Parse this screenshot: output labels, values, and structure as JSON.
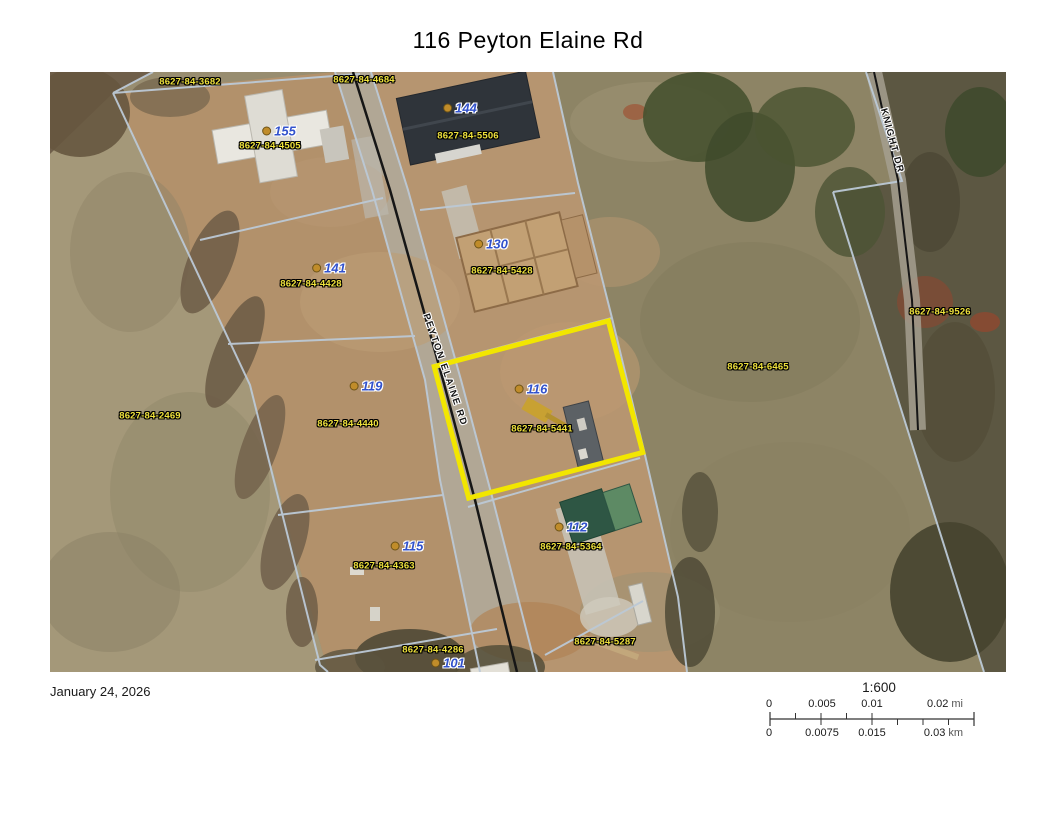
{
  "title": "116 Peyton Elaine Rd",
  "footer": {
    "date": "January 24, 2026"
  },
  "scale_bar": {
    "ratio": "1:600",
    "mi_labels": [
      "0",
      "0.005",
      "0.01",
      "0.02"
    ],
    "mi_unit": "mi",
    "km_labels": [
      "0",
      "0.0075",
      "0.015",
      "0.03"
    ],
    "km_unit": "km"
  },
  "map": {
    "highlighted_parcel": "8627-84-5441",
    "colors": {
      "highlight": "#f2e600",
      "parcel_line": "#bcc9d6",
      "road_centerline": "#161616",
      "parcel_label": "#eee13c",
      "address_label": "#3252cc",
      "address_dot": "#c08c2a"
    },
    "road_labels": [
      {
        "text": "PEYTON ELAINE RD",
        "x": 395,
        "y": 298,
        "angle": 71
      },
      {
        "text": "KNIGHT DR",
        "x": 842,
        "y": 69,
        "angle": 75
      }
    ],
    "parcel_labels": [
      {
        "id": "8627-84-3682",
        "x": 140,
        "y": 10
      },
      {
        "id": "8627-84-4684",
        "x": 314,
        "y": 8
      },
      {
        "id": "8627-84-4505",
        "x": 220,
        "y": 74
      },
      {
        "id": "8627-84-5506",
        "x": 418,
        "y": 64
      },
      {
        "id": "8627-84-4428",
        "x": 261,
        "y": 212
      },
      {
        "id": "8627-84-5428",
        "x": 452,
        "y": 199
      },
      {
        "id": "8627-84-2469",
        "x": 100,
        "y": 344
      },
      {
        "id": "8627-84-4440",
        "x": 298,
        "y": 352
      },
      {
        "id": "8627-84-5441",
        "x": 492,
        "y": 357
      },
      {
        "id": "8627-84-6465",
        "x": 708,
        "y": 295
      },
      {
        "id": "8627-84-9526",
        "x": 890,
        "y": 240
      },
      {
        "id": "8627-84-4363",
        "x": 334,
        "y": 494
      },
      {
        "id": "8627-84-5364",
        "x": 521,
        "y": 475
      },
      {
        "id": "8627-84-4286",
        "x": 383,
        "y": 578
      },
      {
        "id": "8627-84-5287",
        "x": 555,
        "y": 570
      }
    ],
    "address_labels": [
      {
        "number": "155",
        "x": 229,
        "y": 59
      },
      {
        "number": "144",
        "x": 410,
        "y": 36
      },
      {
        "number": "141",
        "x": 279,
        "y": 196
      },
      {
        "number": "130",
        "x": 441,
        "y": 172
      },
      {
        "number": "119",
        "x": 316,
        "y": 314
      },
      {
        "number": "116",
        "x": 481,
        "y": 317
      },
      {
        "number": "115",
        "x": 357,
        "y": 474
      },
      {
        "number": "112",
        "x": 521,
        "y": 455
      },
      {
        "number": "101",
        "x": 398,
        "y": 591
      }
    ]
  }
}
